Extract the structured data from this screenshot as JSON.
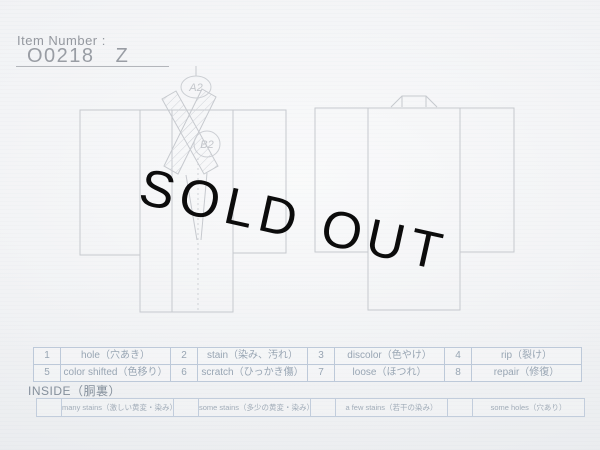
{
  "header": {
    "item_number_label": "Item Number :",
    "item_number_value": "O0218 Z"
  },
  "overlay": {
    "sold_out": "SOLD OUT"
  },
  "diagram": {
    "annotation_a": "A2",
    "annotation_b": "B2"
  },
  "defect_table": {
    "row1": [
      "1",
      "hole（穴あき）",
      "2",
      "stain（染み、汚れ）",
      "3",
      "discolor（色やけ）",
      "4",
      "rip（裂け）"
    ],
    "row2": [
      "5",
      "color shifted（色移り）",
      "6",
      "scratch（ひっかき傷）",
      "7",
      "loose（ほつれ）",
      "8",
      "repair（修復）"
    ]
  },
  "inside": {
    "label": "INSIDE（胴裏）",
    "row": [
      "",
      "many stains（激しい黄変・染み）",
      "",
      "some stains（多少の黄変・染み）",
      "",
      "a few stains（若干の染み）",
      "",
      "some holes（穴あり）"
    ]
  },
  "colors": {
    "background": "#f3f4f6",
    "diagram_line": "#c6c9ce",
    "table_border": "#bdc9d9",
    "table_text": "#98a5b3",
    "sold_out_text": "#0c0c0c"
  }
}
